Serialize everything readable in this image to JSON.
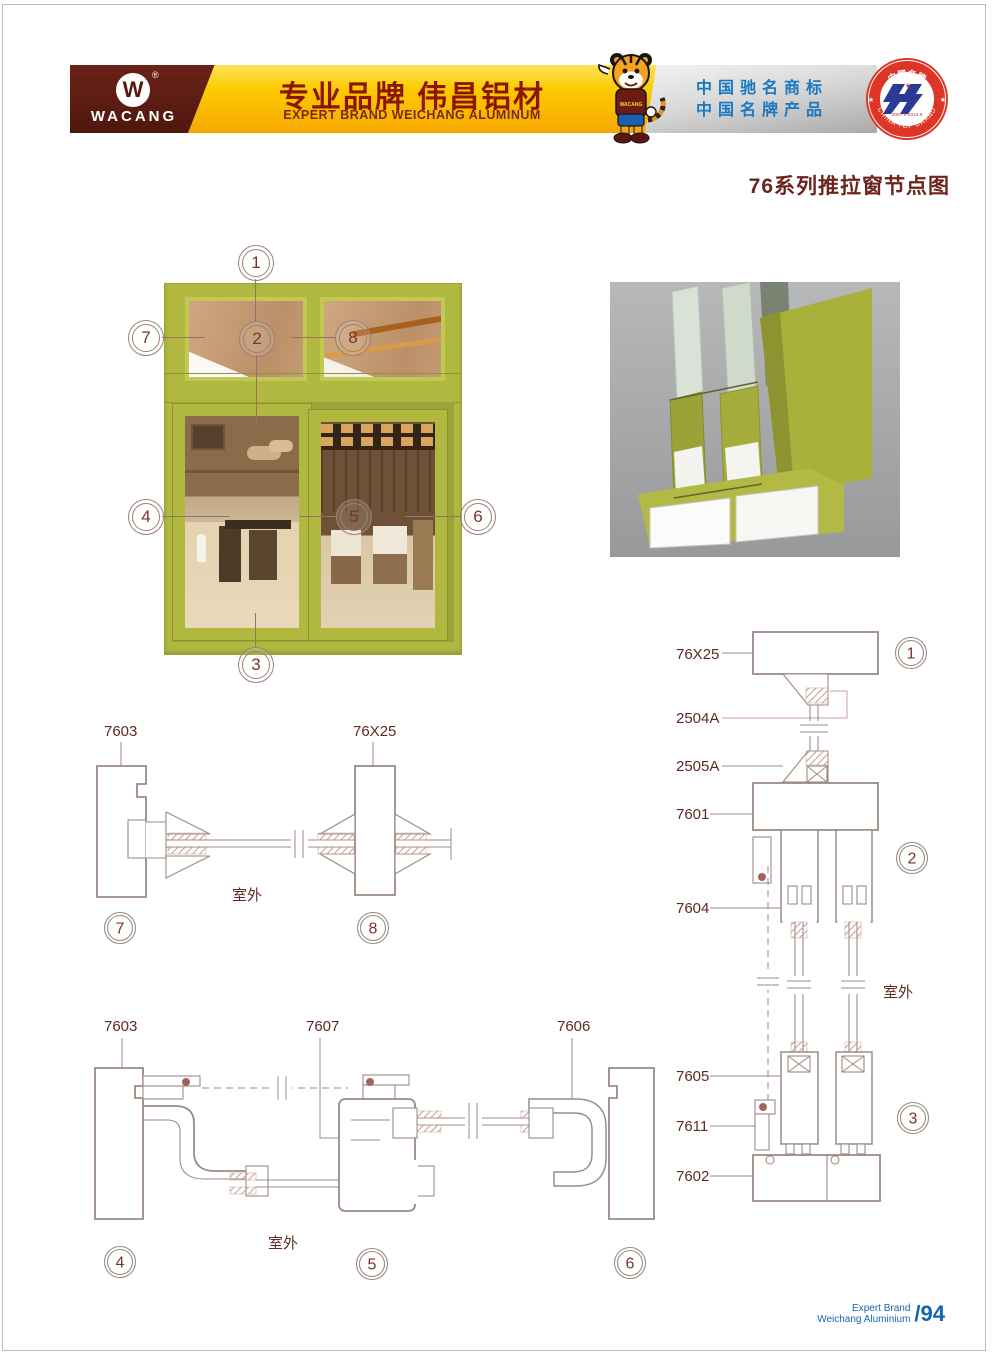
{
  "header": {
    "logo": {
      "brand": "WACANG",
      "monogram": "W",
      "registered": "®"
    },
    "banner": {
      "title_cn": "专业品牌  伟昌铝材",
      "title_en": "EXPERT BRAND WEICHANG ALUMINUM"
    },
    "accolade": {
      "line1": "中国驰名商标",
      "line2": "中国名牌产品"
    },
    "badge": {
      "top": "中国名牌",
      "bottom": "CHINA TOP BRAND",
      "years": "2007.9-2012.9"
    },
    "mascot": {
      "shirt_text": "WACANG"
    }
  },
  "page_title": "76系列推拉窗节点图",
  "diagram": {
    "outdoor_label": "室外",
    "callouts": {
      "c1": "1",
      "c2": "2",
      "c3": "3",
      "c4": "4",
      "c5": "5",
      "c6": "6",
      "c7": "7",
      "c8": "8"
    },
    "part_labels": {
      "p7603": "7603",
      "p76x25": "76X25",
      "p7607": "7607",
      "p7606": "7606",
      "p2504a": "2504A",
      "p2505a": "2505A",
      "p7601": "7601",
      "p7604": "7604",
      "p7605": "7605",
      "p7611": "7611",
      "p7602": "7602"
    }
  },
  "footer": {
    "line1": "Expert Brand",
    "line2": "Weichang Aluminium",
    "page": "/94"
  },
  "colors": {
    "accent_olive": "#b0b840",
    "brand_maroon": "#5b1f16",
    "banner_yellow": "#fccb00",
    "accolade_blue": "#1878c0",
    "badge_red": "#dd3526",
    "line_taupe": "#9c8b84",
    "label_maroon": "#5f2a22",
    "footer_blue": "#1566b0"
  }
}
